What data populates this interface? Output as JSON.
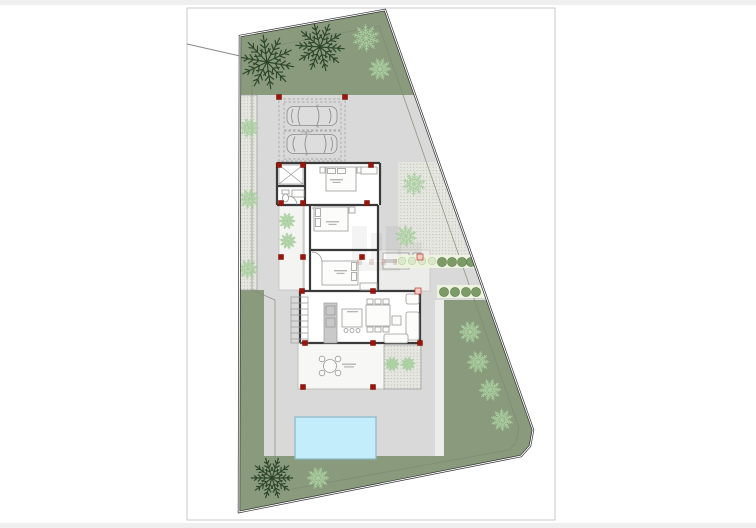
{
  "title": "Architectural site plan drawing of a villa plot",
  "palette": {
    "canvas_edge": "#efefef",
    "page_border": "#c9c9c9",
    "garden_green": "#8a9a7d",
    "paving_gray": "#d9d9d9",
    "stipple_base": "#e6e6e0",
    "pool_fill": "#c3edfa",
    "pool_border": "#8ab8c6",
    "wall": "#3a3a3a",
    "boundary": "#2e2e2e",
    "setback": "#7e8a74",
    "column_red": "#9c150b",
    "column_pale_fill": "#f2cdc5",
    "column_pale_border": "#c0392b",
    "palm_dark": "#2c462a",
    "palm_light": "#a9cf9f",
    "hedge_dark": "#7d9b69",
    "hedge_dark_border": "#5f7d4e",
    "hedge_pale": "#dce8cb",
    "hedge_pale_border": "#b9cfa4",
    "hedge_band": "#edf3df",
    "furniture_line": "#9a9a9a",
    "furniture_fill": "#fcfcfb",
    "counter_fill": "#c9c9c9",
    "car_line": "#8a8a8a",
    "car_fill": "#dddddd",
    "courtyard_fill": "#f4f4f2",
    "porch_fill": "#ececea",
    "terrace_fill": "#f7f7f5",
    "label_mark": "#b5b5b5"
  },
  "site": {
    "boundary_points": "240,36 385,10 533,430 530,446 521,456 239,512",
    "top_green_points": "240,36 385,10 415,95 240,95",
    "right_green_points": "444,300 486,300 533,430 530,446 521,456 444,456",
    "setback_points": "252,50 379,26 519,428 516,443 509,450 275,492 275,300 252,290",
    "stipple_right_points": "398,162 437,162 470,258 398,258",
    "road_line": {
      "x1": 187,
      "y1": 44,
      "x2": 240,
      "y2": 56
    }
  },
  "pool": {
    "x": 295,
    "y": 417,
    "width": 81,
    "height": 42
  },
  "trees": [
    [
      267,
      62,
      3.0,
      10,
      "dark"
    ],
    [
      320,
      47,
      2.7,
      40,
      "dark"
    ],
    [
      272,
      478,
      2.3,
      0,
      "dark"
    ],
    [
      366,
      38,
      1.5,
      15,
      "light"
    ],
    [
      380,
      69,
      1.2,
      0,
      "light"
    ],
    [
      249,
      128,
      1.1,
      0,
      "light"
    ],
    [
      249,
      199,
      1.1,
      30,
      "light"
    ],
    [
      248,
      269,
      1.1,
      60,
      "light"
    ],
    [
      414,
      184,
      1.3,
      20,
      "light"
    ],
    [
      406,
      236,
      1.2,
      50,
      "light"
    ],
    [
      470,
      332,
      1.2,
      0,
      "light"
    ],
    [
      478,
      362,
      1.2,
      35,
      "light"
    ],
    [
      490,
      390,
      1.2,
      70,
      "light"
    ],
    [
      502,
      420,
      1.2,
      15,
      "light"
    ],
    [
      318,
      478,
      1.2,
      0,
      "light"
    ],
    [
      287,
      221,
      0.9,
      0,
      "light"
    ],
    [
      288,
      241,
      0.9,
      45,
      "light"
    ],
    [
      392,
      364,
      0.8,
      0,
      "light"
    ],
    [
      408,
      364,
      0.8,
      30,
      "light"
    ]
  ],
  "columns": [
    [
      279,
      97,
      "red"
    ],
    [
      345,
      97,
      "red"
    ],
    [
      279,
      165,
      "red"
    ],
    [
      303,
      165,
      "red"
    ],
    [
      371,
      165,
      "red"
    ],
    [
      281,
      203,
      "red"
    ],
    [
      303,
      203,
      "red"
    ],
    [
      367,
      203,
      "red"
    ],
    [
      281,
      257,
      "red"
    ],
    [
      303,
      257,
      "red"
    ],
    [
      362,
      257,
      "red"
    ],
    [
      420,
      257,
      "pale"
    ],
    [
      302,
      291,
      "red"
    ],
    [
      373,
      291,
      "red"
    ],
    [
      418,
      291,
      "pale"
    ],
    [
      305,
      343,
      "red"
    ],
    [
      373,
      343,
      "red"
    ],
    [
      420,
      343,
      "red"
    ],
    [
      303,
      387,
      "red"
    ],
    [
      373,
      387,
      "red"
    ]
  ],
  "hedges": {
    "rows": [
      {
        "band": [
          397,
          255,
          77,
          13
        ],
        "circles": [
          [
            402,
            261,
            3.8,
            "pale"
          ],
          [
            412,
            261,
            3.8,
            "pale"
          ],
          [
            422,
            261,
            3.8,
            "pale"
          ],
          [
            432,
            261,
            3.8,
            "pale"
          ],
          [
            442,
            262,
            4.6,
            "dark"
          ],
          [
            452,
            262,
            4.6,
            "dark"
          ],
          [
            462,
            262,
            4.6,
            "dark"
          ],
          [
            471,
            262,
            4.6,
            "dark"
          ]
        ]
      },
      {
        "band": [
          437,
          285,
          49,
          13
        ],
        "circles": [
          [
            444,
            292,
            4.6,
            "dark"
          ],
          [
            455,
            292,
            4.6,
            "dark"
          ],
          [
            466,
            292,
            4.6,
            "dark"
          ],
          [
            476,
            292,
            4.6,
            "dark"
          ]
        ]
      }
    ]
  },
  "cars": [
    [
      312,
      116,
      0
    ],
    [
      312,
      144,
      1
    ]
  ],
  "notes": "Room label text in the source drawing is below legibility at this resolution; labels are rendered as faint marks."
}
